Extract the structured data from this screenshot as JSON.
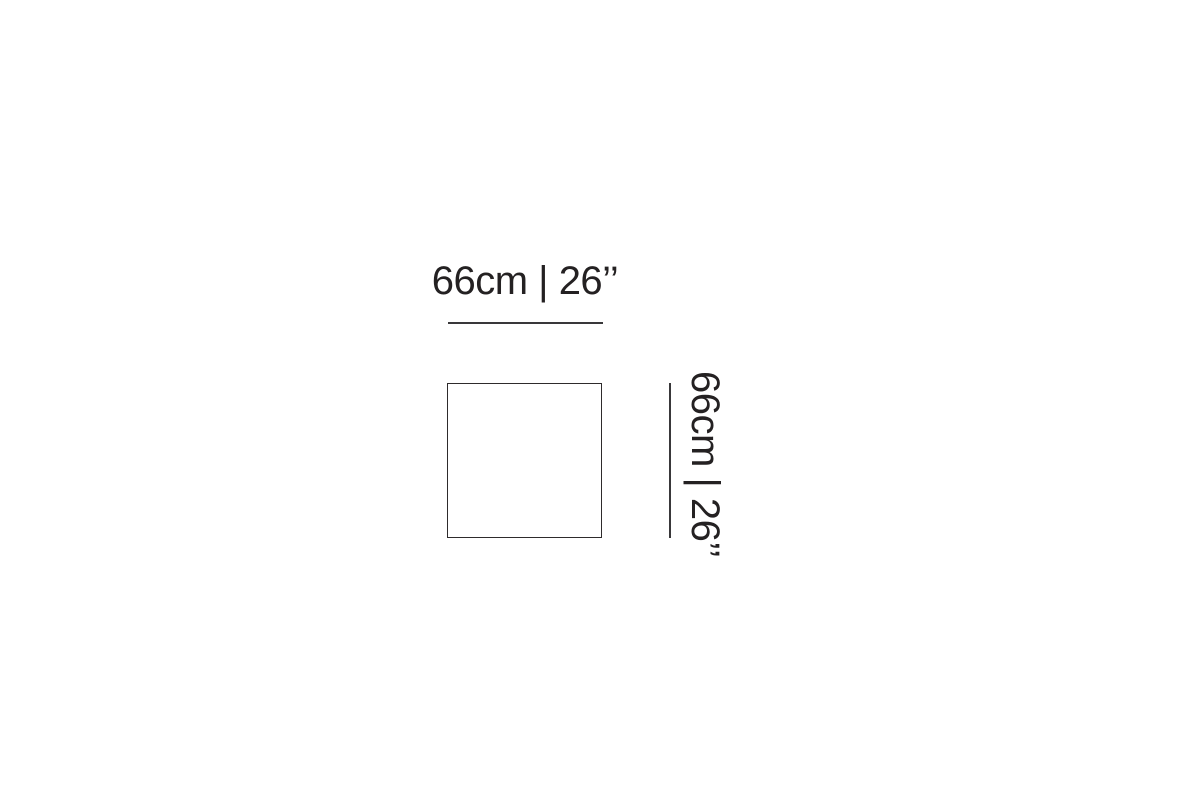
{
  "diagram": {
    "type": "product-dimension-diagram",
    "shape": "square",
    "width_label": "66cm | 26’’",
    "height_label": "66cm | 26’’",
    "width_value_cm": 66,
    "width_value_inches": 26,
    "height_value_cm": 66,
    "height_value_inches": 26,
    "colors": {
      "background": "#ffffff",
      "outline": "#2e2b2c",
      "dimension_line": "#39383a",
      "text": "#242122"
    }
  }
}
